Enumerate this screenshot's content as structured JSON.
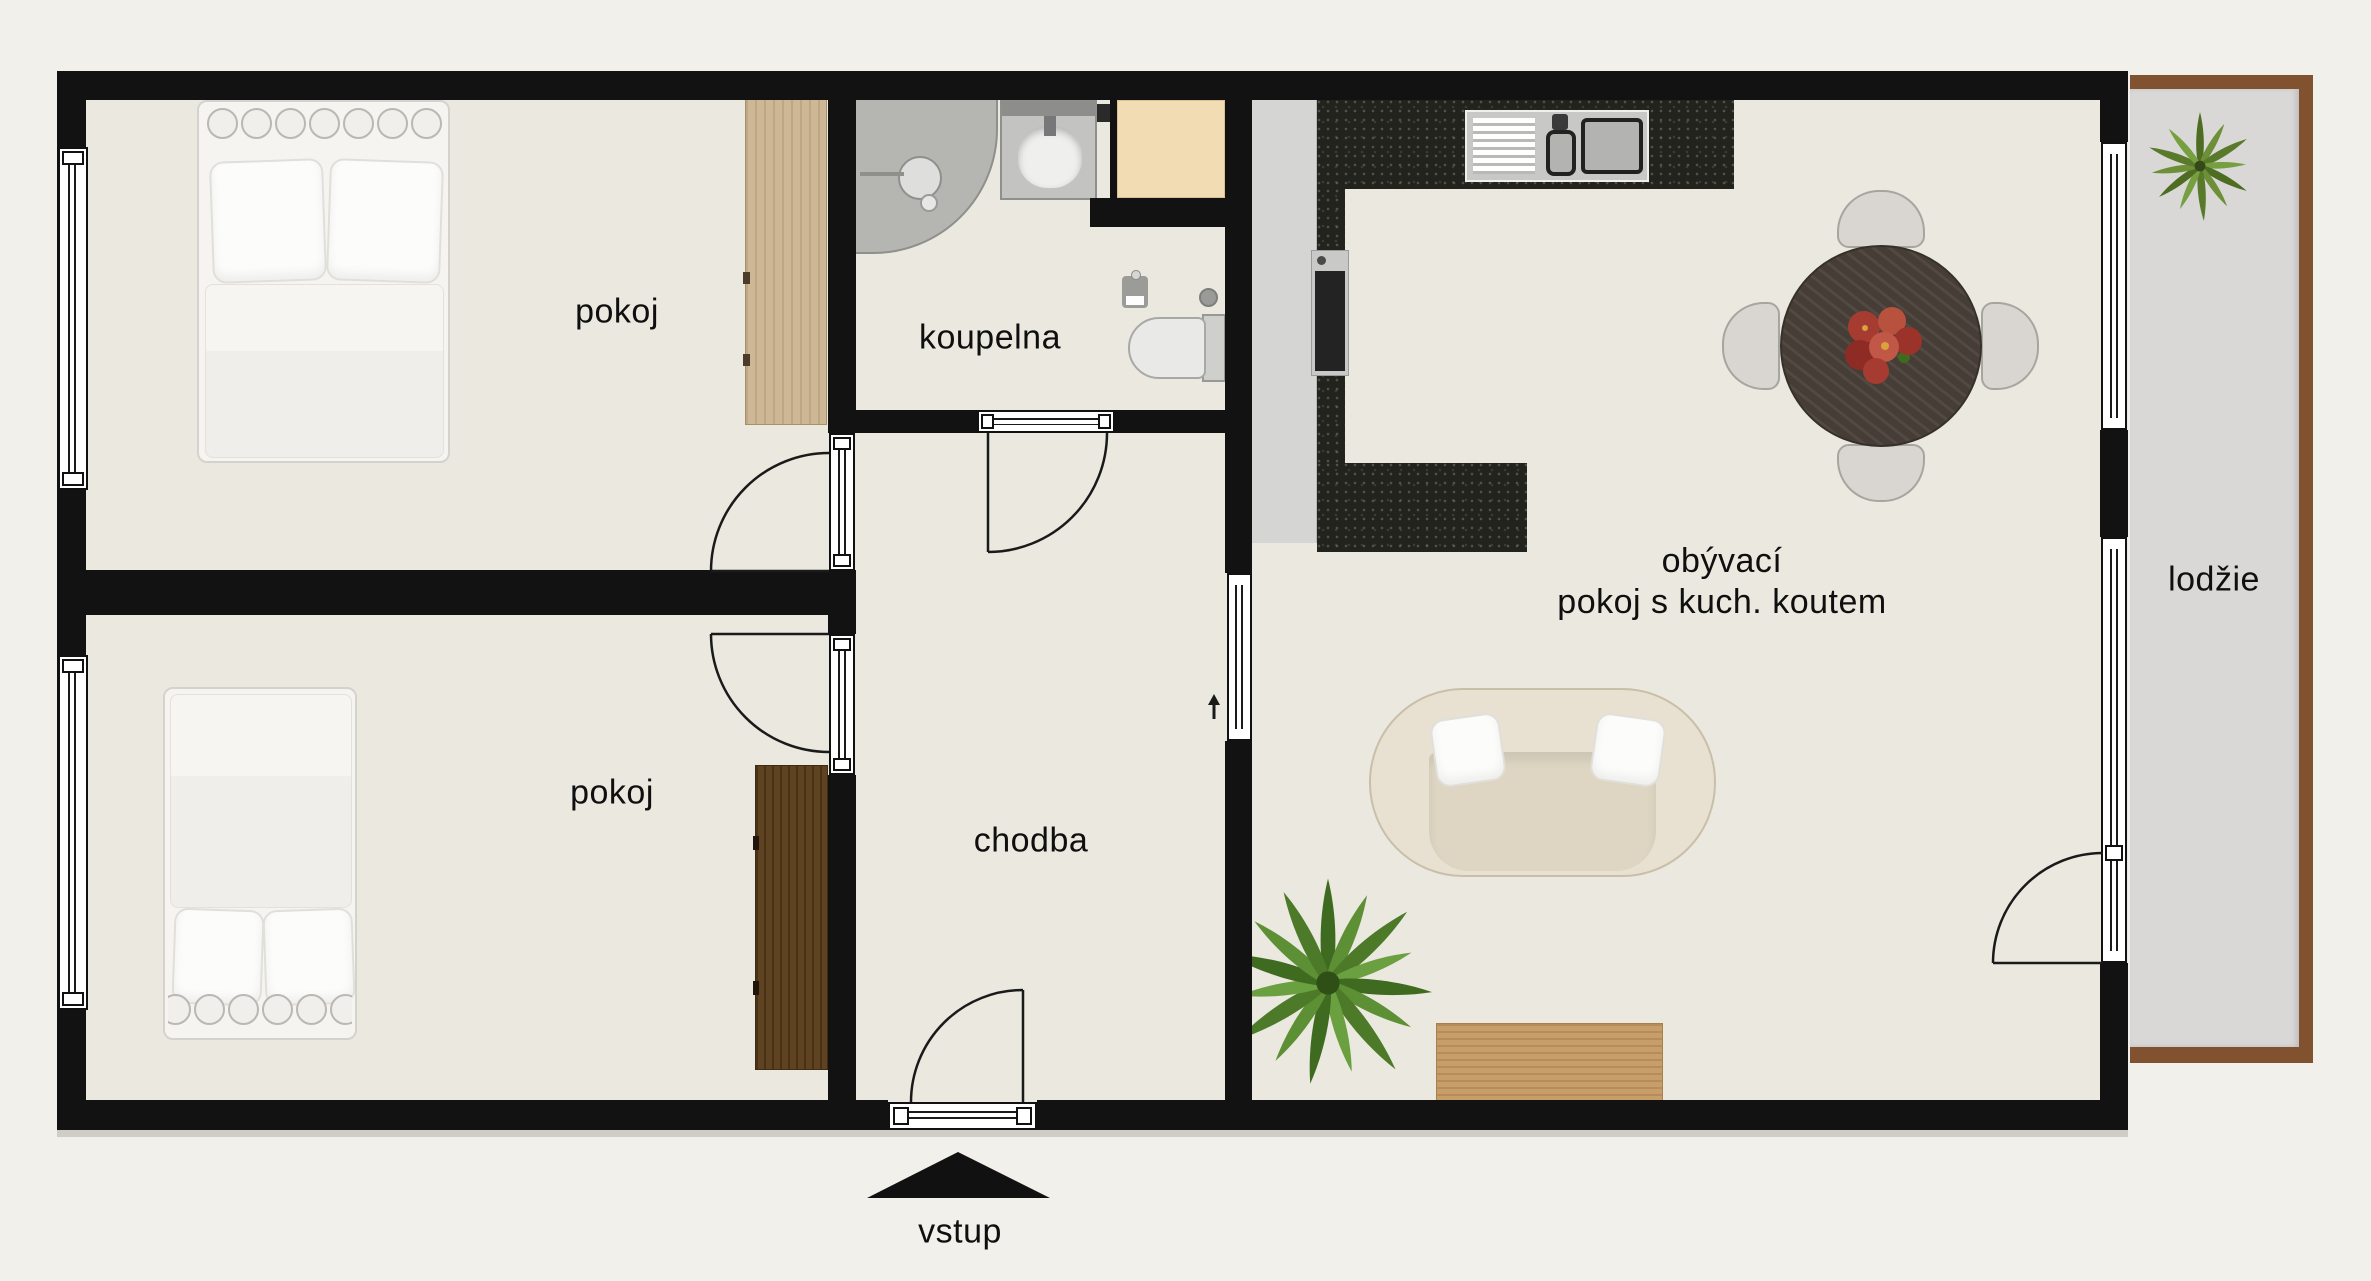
{
  "floorplan": {
    "rooms": {
      "bedroom_top": {
        "label": "pokoj"
      },
      "bathroom": {
        "label": "koupelna"
      },
      "bedroom_bottom": {
        "label": "pokoj"
      },
      "hallway": {
        "label": "chodba"
      },
      "living_room": {
        "label_line1": "obývací",
        "label_line2": "pokoj s kuch. koutem"
      },
      "loggia": {
        "label": "lodžie"
      },
      "entrance": {
        "label": "vstup"
      }
    },
    "colors": {
      "background": "#f2f0ea",
      "floor": "#eae8df",
      "wall": "#121212",
      "kitchen_counter_dark": "#23231e",
      "kitchen_cabinet_gray": "#d5d5d3",
      "loggia_floor": "#d9d8d6",
      "loggia_trim": "#80522f",
      "wardrobe_light_wood": "#cdb795",
      "wardrobe_dark_wood": "#5f421f",
      "sideboard_oak": "#c79d6a",
      "shaft_beige": "#f2dcb4",
      "dining_table_wood": "#463e36",
      "sofa_cream": "#e8e1d2",
      "plant_green": "#4c7a28",
      "flowers_red": "#a63c31"
    }
  }
}
